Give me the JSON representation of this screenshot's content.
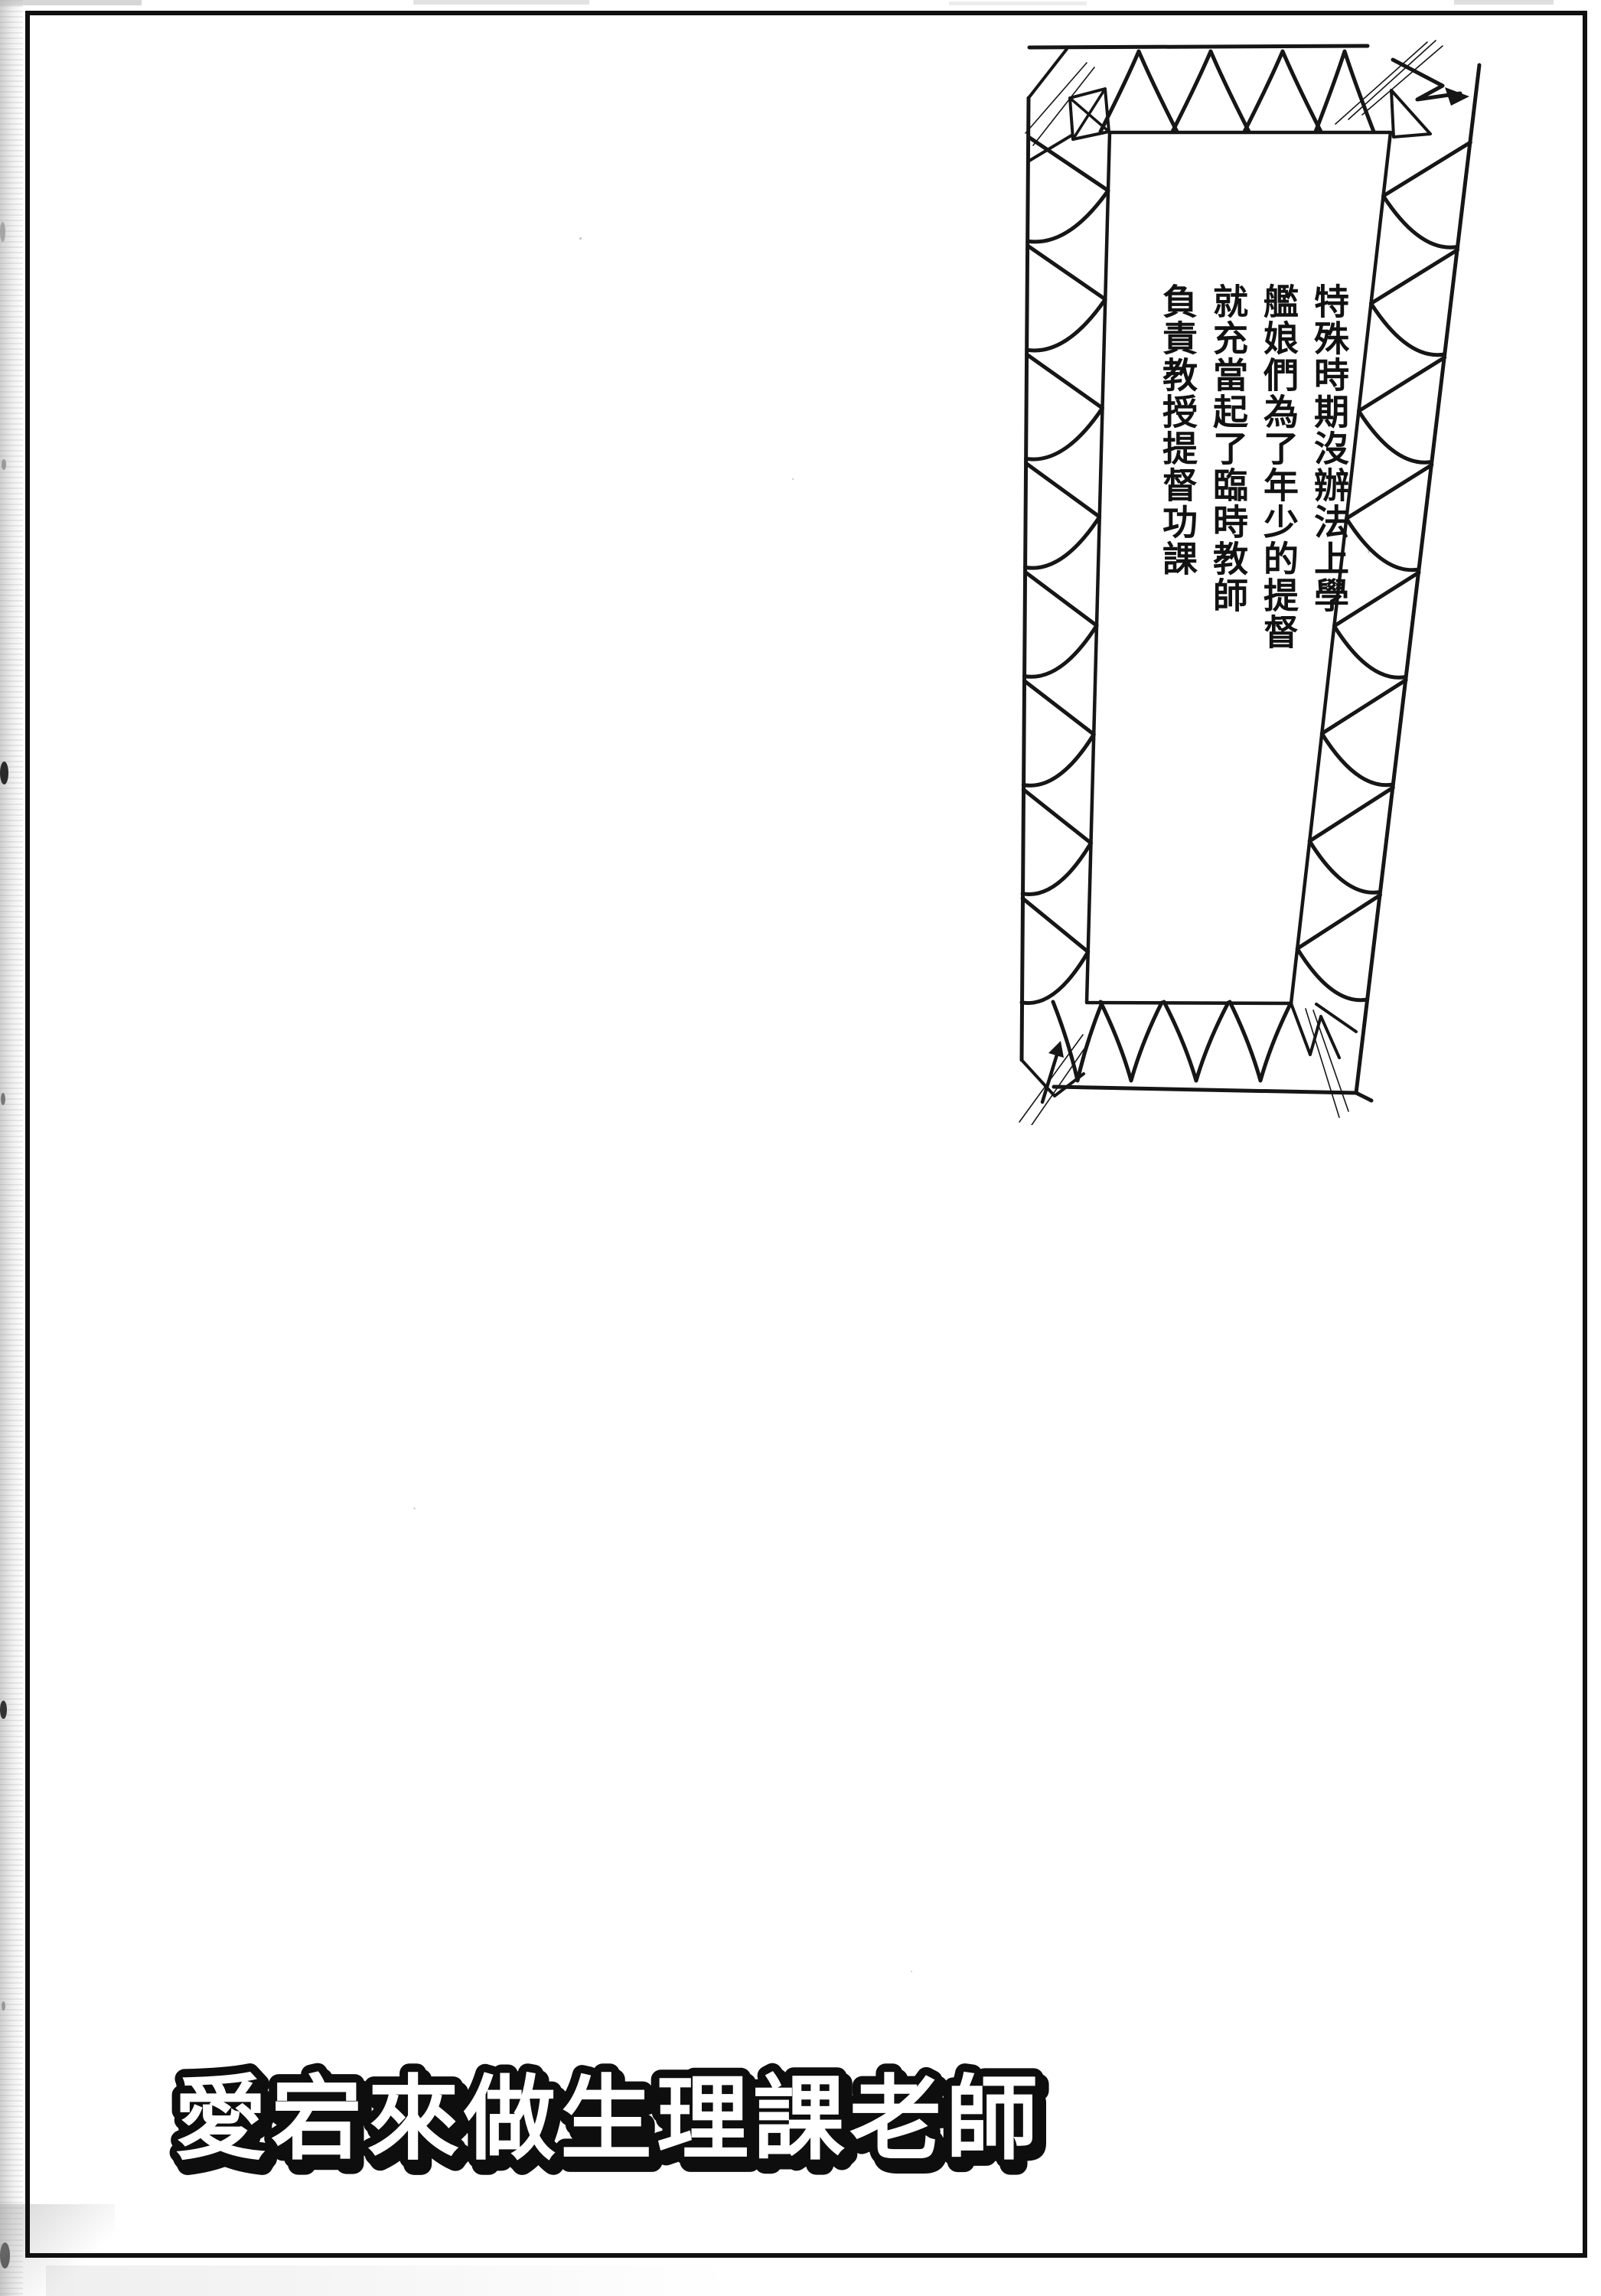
{
  "page": {
    "paper_color": "#ffffff",
    "ink_color": "#161616"
  },
  "narration_box": {
    "lines": [
      "特殊時期沒辦法上學",
      "艦娘們為了年少的提督",
      "就充當起了臨時教師",
      "負責教授提督功課"
    ]
  },
  "title": {
    "text": "愛宕來做生理課老師"
  }
}
